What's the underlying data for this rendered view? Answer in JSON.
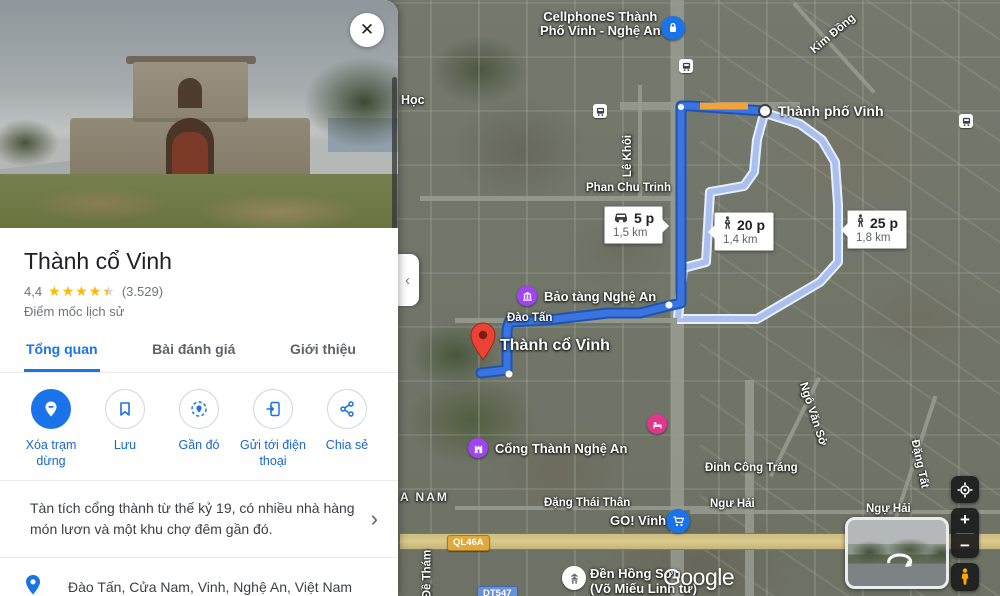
{
  "colors": {
    "accent_blue": "#1a73e8",
    "route_active": "#3b74e0",
    "route_casing": "#1d56b0",
    "route_alt": "#a9bfed",
    "traffic_orange": "#f2a43c",
    "star_gold": "#fbbc04",
    "pin_red": "#ea4335"
  },
  "panel": {
    "close_glyph": "✕",
    "title": "Thành cổ Vinh",
    "rating_value": "4,4",
    "stars_full": "★★★★",
    "star_partial": "★",
    "review_count": "(3.529)",
    "category": "Điểm mốc lịch sử",
    "tabs": {
      "overview": "Tổng quan",
      "reviews": "Bài đánh giá",
      "about": "Giới thiệu"
    },
    "actions": [
      {
        "label": "Xóa trạm dừng"
      },
      {
        "label": "Lưu"
      },
      {
        "label": "Gần đó"
      },
      {
        "label": "Gửi tới điện thoại"
      },
      {
        "label": "Chia sẻ"
      }
    ],
    "description": "Tàn tích cổng thành từ thế kỷ 19, có nhiều nhà hàng món lươn và một khu chợ đêm gần đó.",
    "more_glyph": "›",
    "address": "Đào Tấn, Cửa Nam, Vinh, Nghệ An, Việt Nam"
  },
  "map": {
    "collapse_glyph": "‹",
    "labels": {
      "hoc": "Học",
      "cellphones_1": "CellphoneS Thành",
      "cellphones_2": "Phố Vinh - Nghệ An",
      "kim_dong": "Kim Đồng",
      "thanh_pho_vinh": "Thành phố Vinh",
      "le_khoi": "Lê Khôi",
      "phan_chu_trinh": "Phan Chu Trinh",
      "bao_tang_nghe_an": "Bảo tàng Nghệ An",
      "dao_tan": "Đào Tấn",
      "thanh_co_vinh": "Thành cổ Vinh",
      "cong_thanh_nghe_an": "Cổng Thành Nghệ An",
      "cua_nam": "A NAM",
      "dang_thai_than": "Đặng Thái Thân",
      "go_vinh": "GO! Vinh",
      "den_hong_son_1": "Đền Hồng Sơn",
      "den_hong_son_2": "(Võ Miếu Linh từ)",
      "ngu_hai_left": "Ngư Hải",
      "ngu_hai_right": "Ngự Hải",
      "dinh_cong_trang": "Đinh Công Tráng",
      "ngo_van_so": "Ngô Văn Sở",
      "dang_tat": "Đặng Tất",
      "de_tham": "Đề Thám",
      "ql46a": "QL46A",
      "dt547": "DT547"
    },
    "badges": {
      "drive": {
        "time": "5 p",
        "dist": "1,5 km"
      },
      "walk_main": {
        "time": "20 p",
        "dist": "1,4 km"
      },
      "walk_alt": {
        "time": "25 p",
        "dist": "1,8 km"
      }
    },
    "attribution": "Google"
  },
  "controls": {
    "zoom_in": "+",
    "zoom_out": "−"
  }
}
